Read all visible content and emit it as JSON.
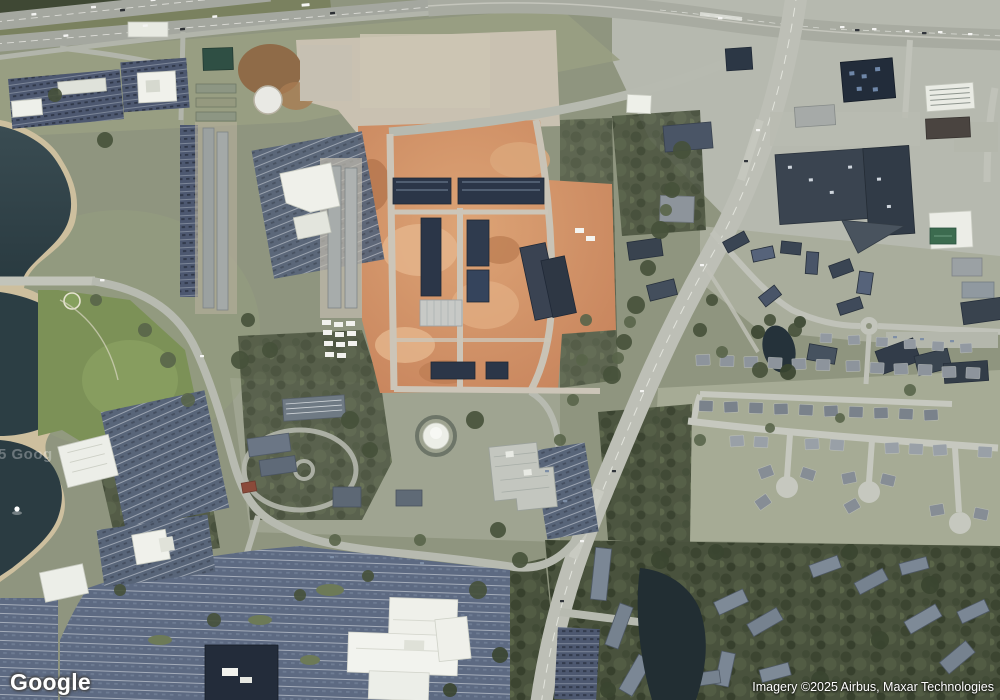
{
  "app": {
    "description": "Google Maps satellite imagery view"
  },
  "overlay": {
    "logo_text": "Google",
    "attribution_text": "Imagery ©2025 Airbus, Maxar Technologies",
    "watermark_text": "5 Goog"
  },
  "palette": {
    "terrain": "#8f957f",
    "water": "#2e4046",
    "shore": "#cdbf9e",
    "construction_dirt": "#cc8b60",
    "forest": "#49523d",
    "road": "#bdbfb6",
    "parking": "#5b6880",
    "roof_dark": "#2b3648",
    "roof_white": "#f0f1eb"
  }
}
